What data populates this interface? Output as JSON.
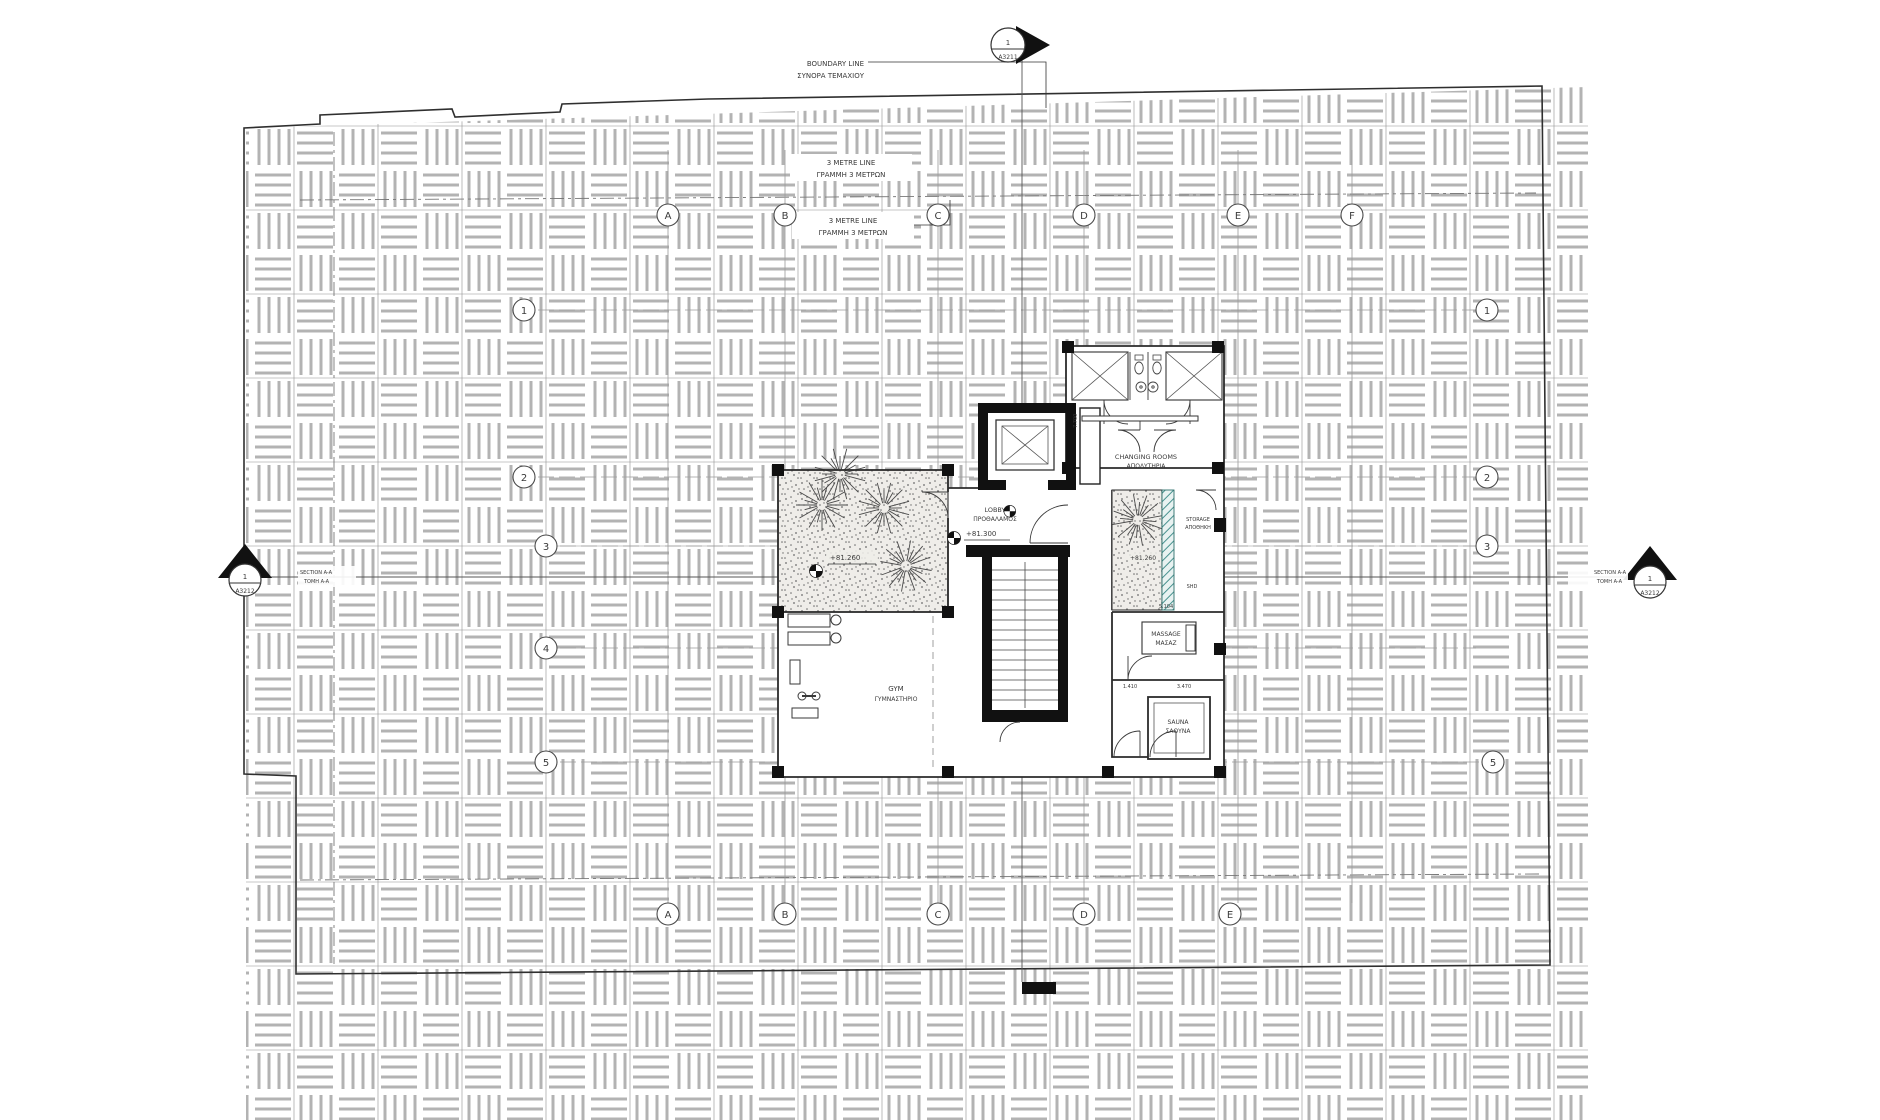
{
  "markers": {
    "top": {
      "num": "1",
      "sheet": "A3211"
    },
    "left": {
      "num": "1",
      "sheet": "A3212"
    },
    "right": {
      "num": "1",
      "sheet": "A3212"
    }
  },
  "section_label": {
    "en": "SECTION A-A",
    "gr": "ΤΟΜΗ A-A"
  },
  "boundary_label": {
    "en": "BOUNDARY LINE",
    "gr": "ΣΥΝΟΡΑ ΤΕΜΑΧΙΟΥ"
  },
  "metre_label": {
    "en": "3 METRE LINE",
    "gr": "ΓΡΑΜΜΗ 3 ΜΕΤΡΩΝ"
  },
  "grid": {
    "top": [
      "A",
      "B",
      "C",
      "D",
      "E",
      "F"
    ],
    "bottom": [
      "A",
      "B",
      "C",
      "D",
      "E"
    ],
    "left": [
      "1",
      "2",
      "3",
      "4",
      "5"
    ],
    "right": [
      "1",
      "2",
      "3",
      "5"
    ]
  },
  "rooms": {
    "changing": {
      "en": "CHANGING ROOMS",
      "gr": "ΑΠΟΔΥΤΗΡΙΑ"
    },
    "lobby": {
      "en": "LOBBY",
      "gr": "ΠΡΟΘΑΛΑΜΟΣ"
    },
    "gym": {
      "en": "GYM",
      "gr": "ΓΥΜΝΑΣΤΗΡΙΟ"
    },
    "massage": {
      "en": "MASSAGE",
      "gr": "ΜΑΣΑΖ"
    },
    "sauna": {
      "en": "SAUNA",
      "gr": "ΣΑΟΥΝΑ"
    },
    "storage": {
      "en": "STORAGE",
      "gr": "ΑΠΟΘΗΚΗ"
    }
  },
  "levels": {
    "lobby": "+81.300",
    "terrace": "+81.260",
    "planter": "+81.260"
  },
  "dims": {
    "changing_left": "7.700",
    "massage_top": "5.104",
    "massage_b1": "1.410",
    "massage_b2": "3.470",
    "shd": "SHD"
  },
  "colors": {
    "teal": "#4a9390",
    "line": "#3a3a3a",
    "hatch": "#b3b3b3"
  }
}
